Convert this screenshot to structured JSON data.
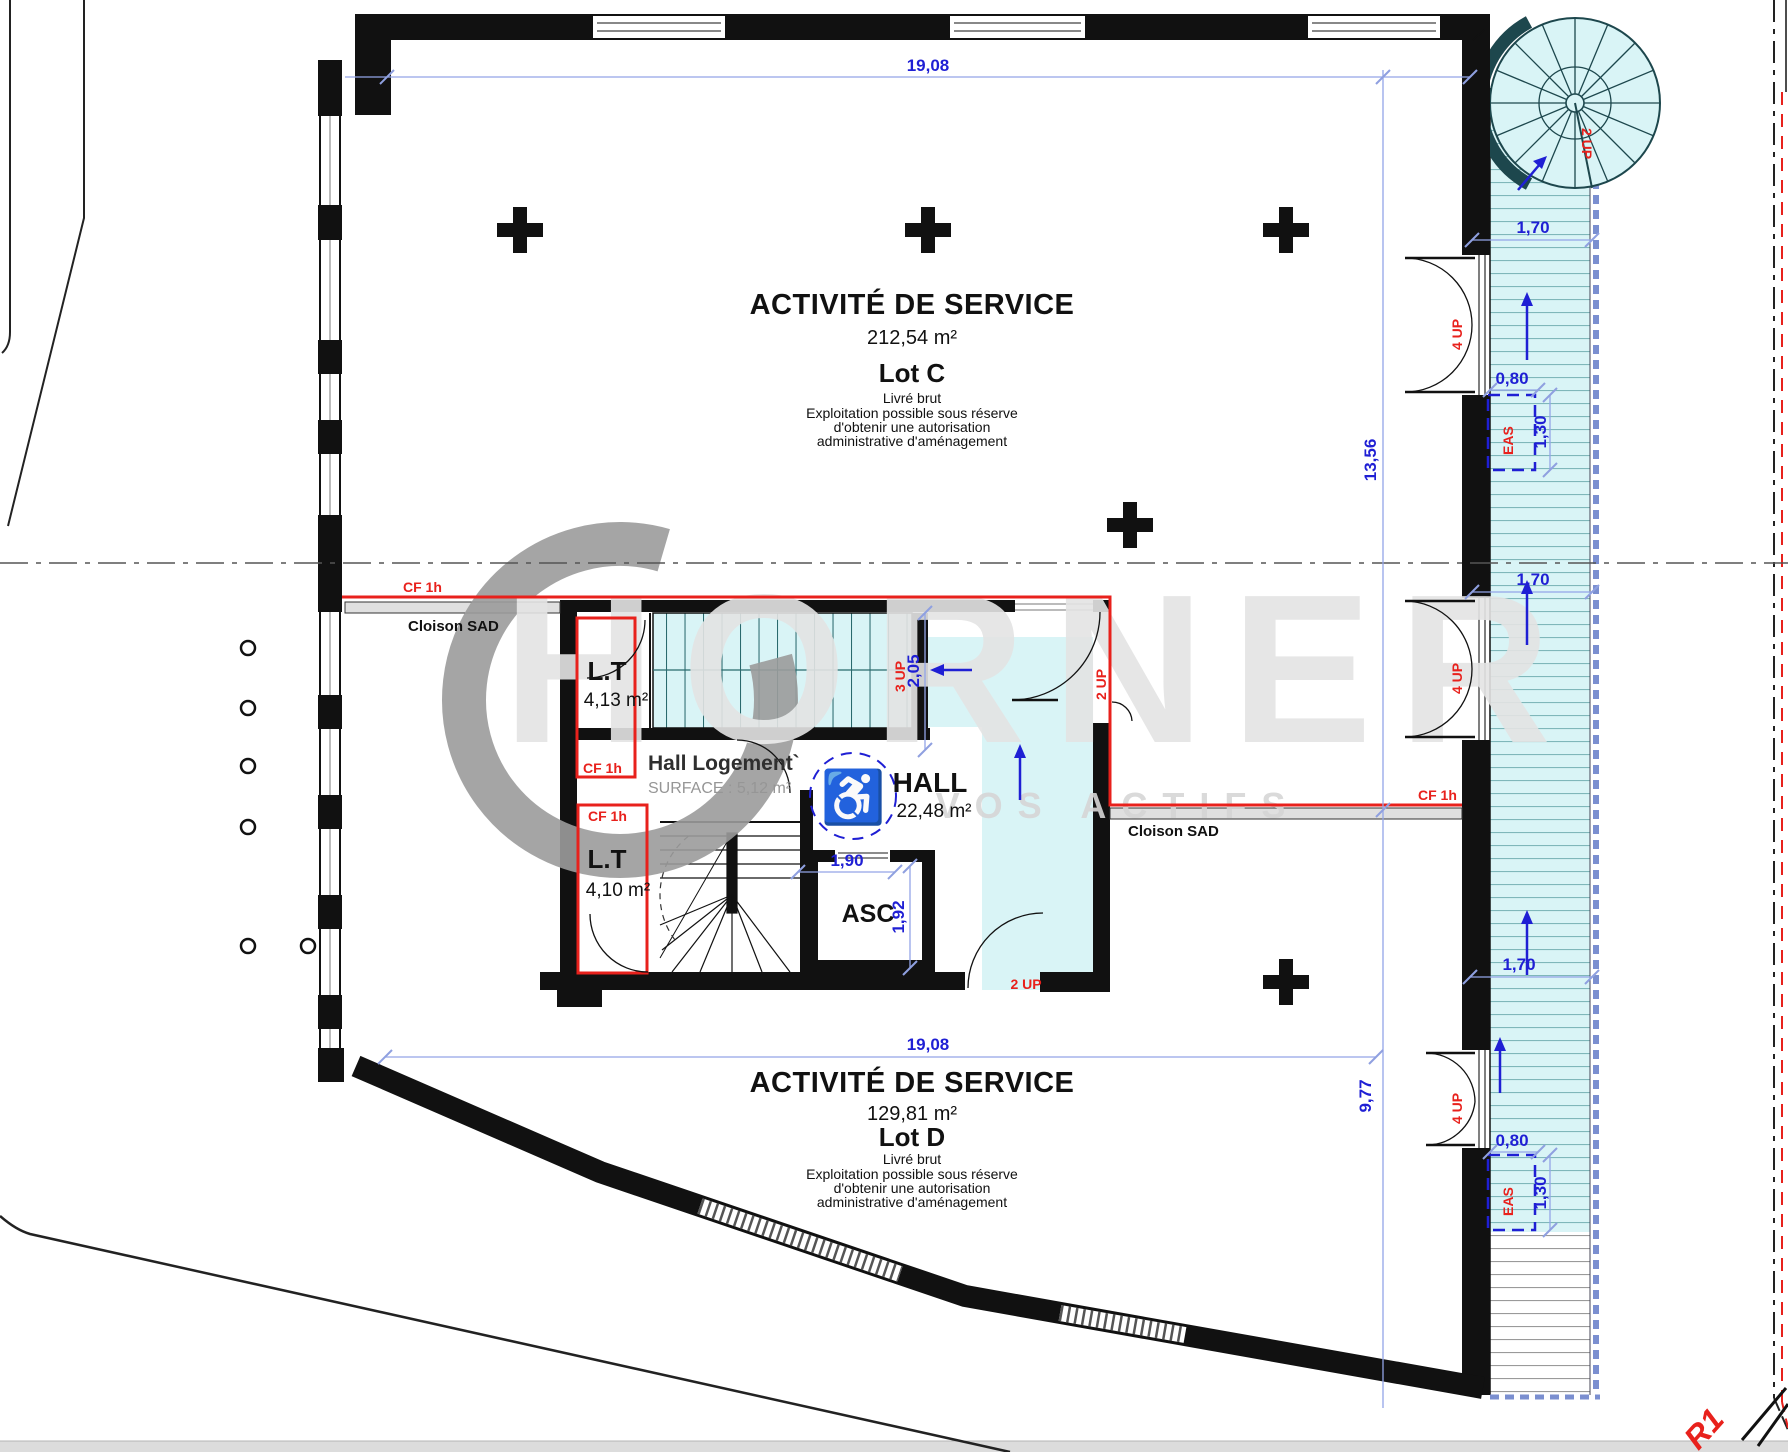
{
  "colors": {
    "dim_blue": "#1f1fd4",
    "grid_blue": "#93a5e8",
    "fire_red": "#e8211c",
    "stair_cyan": "#d9f4f6",
    "teal_dark": "#1d474d",
    "watermark_gray": "#9c9c9c",
    "partition_gray": "#e0e0e0"
  },
  "labels": {
    "service_title": "ACTIVITÉ DE SERVICE",
    "lot_c": {
      "area": "212,54 m²",
      "lot": "Lot C"
    },
    "lot_d": {
      "area": "129,81 m²",
      "lot": "Lot D"
    },
    "notes": {
      "l1": "Livré brut",
      "l2": "Exploitation possible sous réserve",
      "l3": "d'obtenir une autorisation",
      "l4": "administrative d'aménagement"
    },
    "core": {
      "hall": "HALL",
      "hall_area": "22,48 m²",
      "asc": "ASC",
      "lt": "L.T",
      "lt1_area": "4,13 m²",
      "lt2_area": "4,10 m²",
      "hall_logement": "Hall Logement`",
      "hall_logement_surface": "SURFACE : 5,12 m²"
    },
    "fire": {
      "cf1h": "CF 1h",
      "cloison_sad": "Cloison SAD",
      "eas": "EAS"
    },
    "dims": {
      "d19_08": "19,08",
      "d13_56": "13,56",
      "d9_77": "9,77",
      "d1_70": "1,70",
      "d0_80": "0,80",
      "d1_30": "1,30",
      "d2_05": "2,05",
      "d1_90": "1,90",
      "d1_92": "1,92"
    },
    "stairs": {
      "up2": "2 UP",
      "up3": "3 UP",
      "up4": "4 UP"
    },
    "section_marker": "R1",
    "watermark": {
      "name": "HORNER",
      "tagline": "VOS ACTIFS"
    }
  }
}
